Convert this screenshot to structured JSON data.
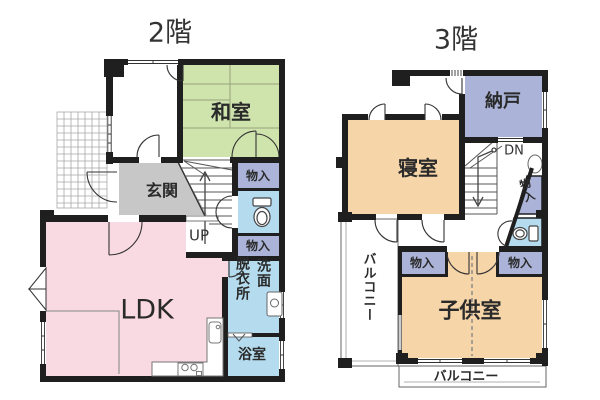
{
  "colors": {
    "wall": "#1f1f1f",
    "tatami_green": "#cfe3ad",
    "ldk_pink": "#f9dae2",
    "room_orange": "#f6d5a8",
    "closet_lavender": "#abb4d8",
    "water_blue": "#b4dcee",
    "genkan_gray": "#c7c7c7"
  },
  "floor2": {
    "title": "2階",
    "labels": {
      "washitsu": "和室",
      "genkan": "玄関",
      "monoire_top": "物入",
      "monoire_mid": "物入",
      "ldk": "LDK",
      "senmen": "洗面",
      "datsuijo": "脱衣所",
      "yokushitsu": "浴室",
      "up": "UP"
    }
  },
  "floor3": {
    "title": "3階",
    "labels": {
      "nando": "納戸",
      "shinshitsu": "寝室",
      "monoire_slant": "物入",
      "monoire_left": "物入",
      "monoire_right": "物入",
      "kodomoshitsu": "子供室",
      "balcony_left": "バルコニー",
      "balcony_bottom": "バルコニー",
      "dn": "DN"
    }
  }
}
